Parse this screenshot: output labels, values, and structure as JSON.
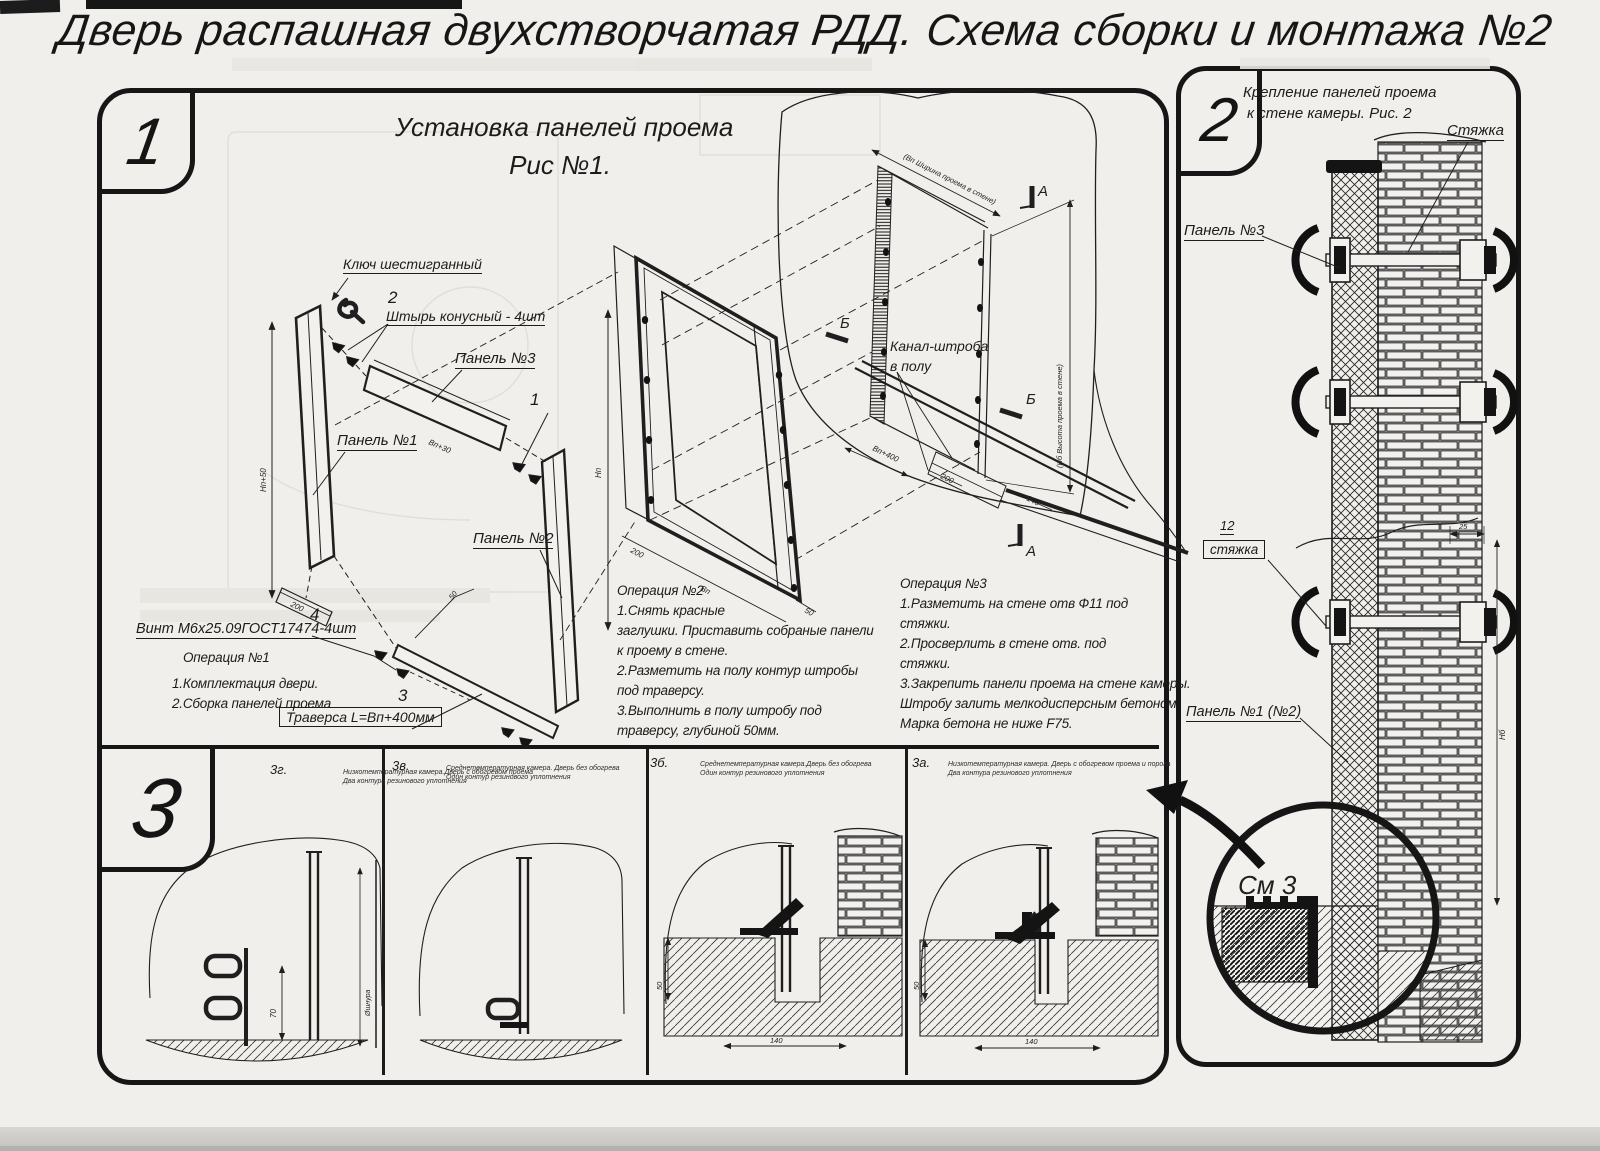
{
  "page": {
    "title": "Дверь распашная двухстворчатая РДД.  Схема сборки и монтажа №2"
  },
  "fig1": {
    "tab": "1",
    "title_line1": "Установка панелей проема",
    "title_line2": "Рис №1.",
    "labels": {
      "hex_key": "Ключ шестигранный",
      "pin_no": "2",
      "pin": "Штырь конусный - 4шт",
      "panel3": "Панель №3",
      "panel1": "Панель №1",
      "panel2": "Панель №2",
      "item1": "1",
      "screw_no": "4",
      "screw": "Винт М6х25.09ГОСТ17474-4шт",
      "traverse_no": "3",
      "traverse": "Траверса  L=Вп+400мм",
      "channel_line1": "Канал-штроба",
      "channel_line2": "в полу",
      "mark_a": "А",
      "mark_b": "Б"
    },
    "dims": {
      "np50": "Нп+50",
      "d200": "200",
      "vp30": "Вп+30",
      "np": "Нп",
      "vp": "Вп",
      "d50": "50",
      "vp400": "Вп+400",
      "d140": "140",
      "width_note": "(Вп Ширина проема в стене)",
      "height_note": "(Нб Высота проема в стене)"
    },
    "op1": {
      "title": "Операция №1",
      "lines": [
        "1.Комплектация двери.",
        "2.Сборка панелей проема"
      ]
    },
    "op2": {
      "title": "Операция №2",
      "lines": [
        "1.Снять красные",
        "заглушки. Приставить собраные панели",
        "к проему в стене.",
        "2.Разметить на полу контур штробы",
        "под траверсу.",
        "3.Выполнить в полу штробу под",
        "траверсу, глубиной 50мм."
      ]
    },
    "op3": {
      "title": "Операция №3",
      "lines": [
        "1.Разметить на стене отв Ф11 под",
        "стяжки.",
        "2.Просверлить в стене отв.  под",
        "стяжки.",
        "3.Закрепить панели проема на стене камеры.",
        "Штробу залить мелкодисперсным бетоном",
        "Марка бетона не ниже  F75."
      ]
    }
  },
  "fig2": {
    "tab": "2",
    "title_line1": "Крепление панелей проема",
    "title_line2": "к стене камеры. Рис. 2",
    "labels": {
      "tie": "Стяжка",
      "panel3": "Панель №3",
      "tie_no": "12",
      "tie_boxed": "стяжка",
      "panel12": "Панель №1 (№2)",
      "see": "См 3"
    },
    "dims": {
      "d25": "25",
      "nb": "Нб"
    }
  },
  "fig3": {
    "tab": "3",
    "views": [
      {
        "code": "3г.",
        "caption_line1": "Низкотемпературная камера.Дверь с обогревом проема",
        "caption_line2": "Два контура резинового уплотнения",
        "dim_a": "70",
        "dim_b": "Øшнура"
      },
      {
        "code": "3в.",
        "caption_line1": "Среднетемпературная камера. Дверь без обогрева",
        "caption_line2": "Один контур резинового уплотнения"
      },
      {
        "code": "3б.",
        "caption_line1": "Среднетемпературная камера.Дверь без обогрева",
        "caption_line2": "Один контур резинового уплотнения",
        "dim_a": "50",
        "dim_b": "140"
      },
      {
        "code": "3а.",
        "caption_line1": "Низкотемпературная камера. Дверь с обогревом проема и порога",
        "caption_line2": "Два контура резинового уплотнения",
        "dim_a": "50",
        "dim_b": "140"
      }
    ]
  }
}
